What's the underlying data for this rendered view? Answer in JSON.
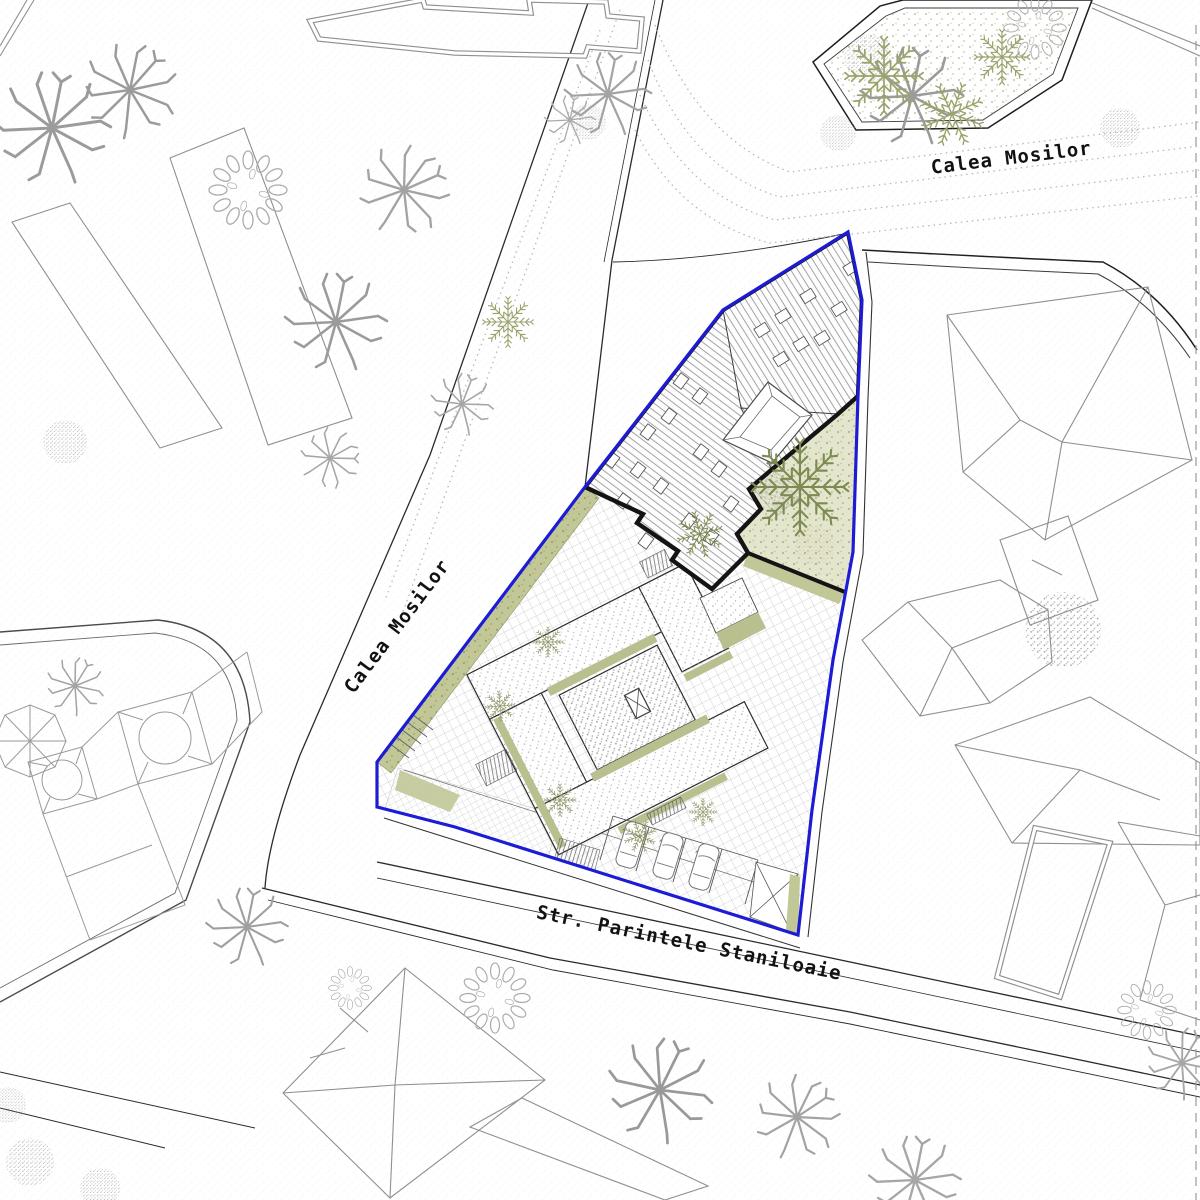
{
  "drawing": {
    "kind": "architectural site plan",
    "streets": [
      {
        "name": "Calea Mosilor",
        "location": "northeast street"
      },
      {
        "name": "Calea Mosilor",
        "location": "west street"
      },
      {
        "name": "Str. Parintele Staniloaie",
        "location": "south street"
      }
    ],
    "colors": {
      "site_boundary_blue": "#1d1bd4",
      "building_outline_black": "#141414",
      "roof_hatch_gray": "#5a5a5a",
      "paving_grid_gray": "#c6c6c6",
      "vegetation_olive": "#a8ad7e",
      "planter_olive": "#b9bf8f",
      "tree_gray": "#9b9b9b",
      "neighbor_building_gray": "#8f8f8f"
    },
    "features": {
      "parking_car_count": 3,
      "tram_lines": "dotted",
      "site_shape": "irregular pentagon"
    }
  }
}
